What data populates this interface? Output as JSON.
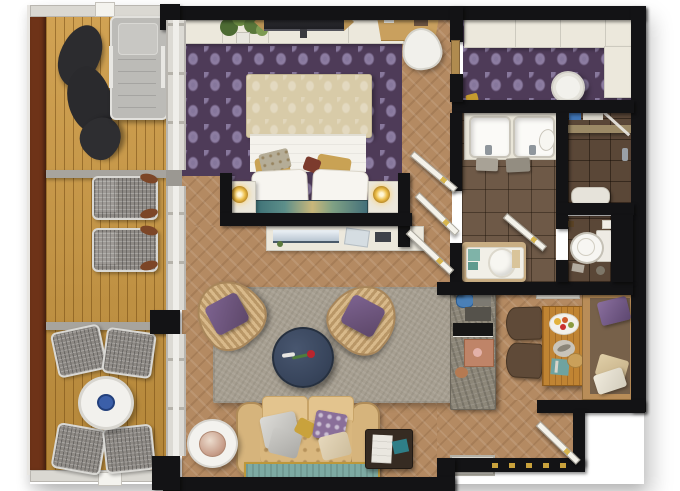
{
  "scene": {
    "type": "floor-plan-3d-rendering",
    "subject": "hotel suite top-view floor plan with wooden balcony",
    "visible_text": []
  },
  "palette": {
    "wall": "#131315",
    "deck-wood": "#cc9840",
    "deck-rail": "#6e3318",
    "interior-wood": "#b48a62",
    "bedroom-carpet": "#4e3b58",
    "bath-tile": "#6e5947",
    "shower-tile": "#5a4737",
    "rug": "#a79f91",
    "sofa-beige": "#d9b77e",
    "coffee-table-navy": "#3b4860",
    "accent-teal": "#7daaa3",
    "accent-gold": "#c9a23c",
    "accent-purple": "#6b5376",
    "kitchen-stone": "#8d8779",
    "dining-wood": "#c08433",
    "cream-furniture": "#ece8dc",
    "outdoor-gray": "#8d8984"
  },
  "rooms": [
    {
      "name": "balcony",
      "floor": "wood-deck",
      "furniture": [
        "beanbag-lounger",
        "sun-lounger",
        "deck-lounge-chair",
        "deck-lounge-chair",
        "round-outdoor-table",
        "blue-bowl",
        "outdoor-chair",
        "outdoor-chair",
        "outdoor-chair",
        "outdoor-chair"
      ]
    },
    {
      "name": "bedroom",
      "floor": "purple-damask-carpet",
      "furniture": [
        "double-bed",
        "headboard-art-panel",
        "nightstand-left",
        "nightstand-right",
        "gold-lamp",
        "gold-lamp",
        "wall-tv",
        "plant",
        "desk",
        "desk-chair",
        "tv-console"
      ]
    },
    {
      "name": "walk-in-closet",
      "floor": "purple-damask-carpet",
      "furniture": [
        "wardrobe-top",
        "wardrobe-right",
        "round-stool",
        "gold-clutch"
      ]
    },
    {
      "name": "bathroom",
      "floor": "brown-tile",
      "furniture": [
        "double-vanity",
        "sink",
        "sink",
        "towels",
        "bathtub"
      ]
    },
    {
      "name": "shower-room",
      "floor": "dark-tile",
      "furniture": [
        "shower-bench",
        "shower-shelf",
        "glass-screen"
      ]
    },
    {
      "name": "wc",
      "floor": "dark-tile",
      "furniture": [
        "toilet",
        "toilet-paper"
      ]
    },
    {
      "name": "living-room",
      "floor": "herringbone-wood",
      "furniture": [
        "area-rug",
        "round-coffee-table",
        "rose",
        "armchair-left",
        "armchair-right",
        "sofa",
        "teal-bench",
        "side-table",
        "table-lamp",
        "luggage-bench"
      ]
    },
    {
      "name": "kitchen-dining",
      "floor": "herringbone-wood",
      "furniture": [
        "kitchen-counter",
        "kettle",
        "coffee-machine",
        "minibar-shelf",
        "dining-table",
        "food-platter",
        "dining-chair",
        "dining-chair",
        "dining-bench",
        "bench-pillows"
      ]
    },
    {
      "name": "entry",
      "floor": "herringbone-wood",
      "furniture": [
        "entry-door",
        "doormat",
        "threshold-gold-trim"
      ]
    }
  ],
  "doors": [
    "closet-passage-door",
    "bathroom-door",
    "hallway-door-upper",
    "hallway-door-lower",
    "wc-door",
    "entry-door"
  ],
  "windows": [
    "bedroom-sliding-glass",
    "living-sliding-glass-upper",
    "living-sliding-glass-lower"
  ]
}
